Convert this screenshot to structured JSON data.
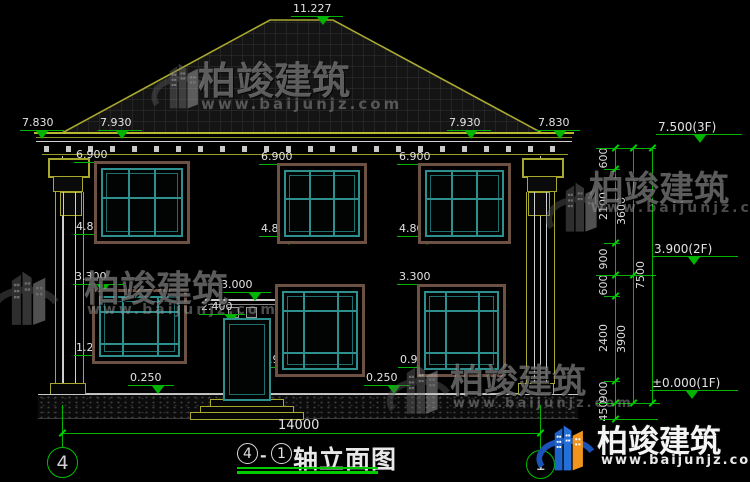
{
  "watermark": {
    "brand": "柏竣建筑",
    "site": "www.baijunjz.com"
  },
  "logo": {
    "brand": "柏竣建筑",
    "site": "www.baijunjz.com"
  },
  "title": {
    "axis_start": "4",
    "axis_end": "1",
    "dash": "-",
    "text": "轴立面图"
  },
  "axes": {
    "left_bubble": "4",
    "right_bubble": "1",
    "span_dim": "14000"
  },
  "elevation_markers": [
    {
      "label": "11.227",
      "x": 291,
      "y": 16,
      "w": 52,
      "t": 26
    },
    {
      "label": "7.830",
      "x": 20,
      "y": 130,
      "w": 44,
      "t": 16
    },
    {
      "label": "7.930",
      "x": 98,
      "y": 130,
      "w": 44,
      "t": 18
    },
    {
      "label": "7.930",
      "x": 447,
      "y": 130,
      "w": 44,
      "t": 18
    },
    {
      "label": "7.830",
      "x": 536,
      "y": 130,
      "w": 44,
      "t": 18
    },
    {
      "label": "6.900",
      "x": 74,
      "y": 162,
      "w": 50,
      "t": 24
    },
    {
      "label": "6.900",
      "x": 259,
      "y": 164,
      "w": 50,
      "t": 24
    },
    {
      "label": "6.900",
      "x": 397,
      "y": 164,
      "w": 50,
      "t": 24
    },
    {
      "label": "4.800",
      "x": 74,
      "y": 234,
      "w": 50,
      "t": 24
    },
    {
      "label": "4.800",
      "x": 259,
      "y": 236,
      "w": 50,
      "t": 24
    },
    {
      "label": "4.800",
      "x": 397,
      "y": 236,
      "w": 50,
      "t": 24
    },
    {
      "label": "3.300",
      "x": 73,
      "y": 284,
      "w": 50,
      "t": 24
    },
    {
      "label": "3.300",
      "x": 397,
      "y": 284,
      "w": 50,
      "t": 24
    },
    {
      "label": "3.000",
      "x": 219,
      "y": 292,
      "w": 52,
      "t": 30
    },
    {
      "label": "2.400",
      "x": 199,
      "y": 314,
      "w": 46,
      "t": 26
    },
    {
      "label": "1.200",
      "x": 74,
      "y": 355,
      "w": 46,
      "t": 24
    },
    {
      "label": "0.900",
      "x": 260,
      "y": 367,
      "w": 46,
      "t": 24
    },
    {
      "label": "0.900",
      "x": 398,
      "y": 367,
      "w": 46,
      "t": 24
    },
    {
      "label": "0.250",
      "x": 128,
      "y": 385,
      "w": 46,
      "t": 24
    },
    {
      "label": "0.250",
      "x": 364,
      "y": 385,
      "w": 46,
      "t": 24
    },
    {
      "label": "7.500(3F)",
      "x": 656,
      "y": 134,
      "w": 86,
      "t": 38,
      "big": true
    },
    {
      "label": "3.900(2F)",
      "x": 652,
      "y": 256,
      "w": 86,
      "t": 36,
      "big": true
    },
    {
      "label": "±0.000(1F)",
      "x": 650,
      "y": 390,
      "w": 88,
      "t": 36,
      "big": true
    }
  ],
  "right_dim_columns": [
    {
      "x": 615,
      "y1": 148,
      "y2": 419,
      "label_x": 604,
      "segments": [
        {
          "v": "600",
          "y": 158
        },
        {
          "v": "2100",
          "y": 206
        },
        {
          "v": "900",
          "y": 259
        },
        {
          "v": "600",
          "y": 285
        },
        {
          "v": "2400",
          "y": 338
        },
        {
          "v": "900",
          "y": 392
        },
        {
          "v": "450",
          "y": 411
        }
      ],
      "ticks": [
        148,
        169,
        243,
        275,
        296,
        381,
        403,
        419
      ]
    },
    {
      "x": 633,
      "y1": 148,
      "y2": 403,
      "label_x": 622,
      "segments": [
        {
          "v": "3600",
          "y": 211
        },
        {
          "v": "3900",
          "y": 339
        }
      ],
      "ticks": [
        148,
        275,
        403
      ]
    },
    {
      "x": 652,
      "y1": 148,
      "y2": 403,
      "label_x": 641,
      "segments": [
        {
          "v": "7500",
          "y": 275
        }
      ],
      "ticks": [
        148,
        403
      ]
    }
  ],
  "green_lines": {
    "h": [
      {
        "x": 596,
        "y": 148,
        "w": 60
      },
      {
        "x": 604,
        "y": 169,
        "w": 16
      },
      {
        "x": 604,
        "y": 243,
        "w": 16
      },
      {
        "x": 596,
        "y": 275,
        "w": 60
      },
      {
        "x": 604,
        "y": 296,
        "w": 16
      },
      {
        "x": 604,
        "y": 381,
        "w": 16
      },
      {
        "x": 596,
        "y": 403,
        "w": 64
      },
      {
        "x": 600,
        "y": 419,
        "w": 58
      },
      {
        "x": 62,
        "y": 433,
        "w": 478
      }
    ],
    "v": [
      {
        "x": 62,
        "y": 405,
        "h": 42
      },
      {
        "x": 540,
        "y": 405,
        "h": 45
      }
    ],
    "end_ticks": [
      {
        "x": 62,
        "y": 433
      },
      {
        "x": 540,
        "y": 433
      }
    ]
  },
  "windows": {
    "second_floor": [
      {
        "x": 98,
        "y": 165,
        "w": 88,
        "h": 75
      },
      {
        "x": 281,
        "y": 167,
        "w": 82,
        "h": 73
      },
      {
        "x": 422,
        "y": 167,
        "w": 85,
        "h": 73
      }
    ],
    "first_floor": [
      {
        "x": 96,
        "y": 293,
        "w": 87,
        "h": 67
      },
      {
        "x": 279,
        "y": 288,
        "w": 82,
        "h": 85
      },
      {
        "x": 421,
        "y": 288,
        "w": 81,
        "h": 85
      }
    ],
    "door": {
      "x": 223,
      "y": 318,
      "w": 44,
      "h": 79
    }
  }
}
